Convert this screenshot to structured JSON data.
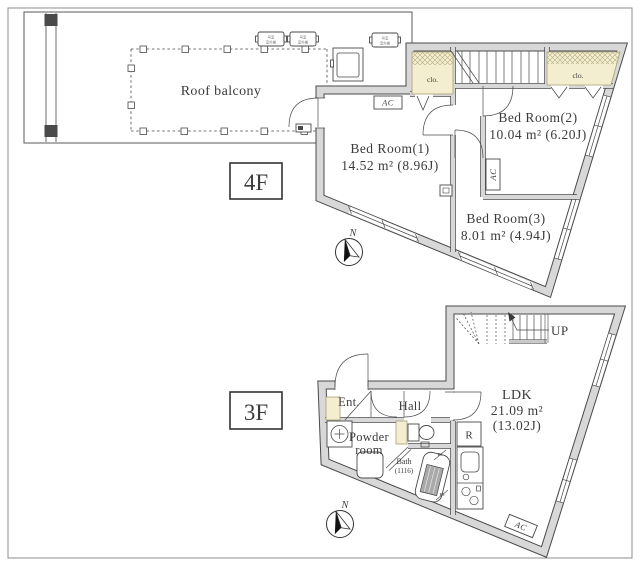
{
  "colors": {
    "line-dark": "#4a4a4a",
    "wall-fill": "#d8d8d8",
    "closet-fill": "#f2eecf",
    "closet-edge": "#a79f78",
    "ink": "#3b3b3b",
    "stair-gray": "#c9c9c9"
  },
  "f4": {
    "floor_tag": "4F",
    "balcony_label": "Roof balcony",
    "outdoor_unit_line1": "号室",
    "outdoor_unit_line2": "室外機",
    "rooms": {
      "bed1_name": "Bed Room(1)",
      "bed1_area": "14.52 m² (8.96J)",
      "bed2_name": "Bed Room(2)",
      "bed2_area": "10.04 m² (6.20J)",
      "bed3_name": "Bed Room(3)",
      "bed3_area": "8.01 m² (4.94J)"
    },
    "closet1": "clo.",
    "closet2": "clo.",
    "ac1": "AC",
    "ac2": "AC",
    "north": "N"
  },
  "f3": {
    "floor_tag": "3F",
    "rooms": {
      "ldk_name": "LDK",
      "ldk_area1": "21.09 m²",
      "ldk_area2": "(13.02J)",
      "ent": "Ent.",
      "hall": "Hall",
      "powder1": "Powder",
      "powder2": "room",
      "bath_name": "Bath",
      "bath_size": "(1116)"
    },
    "up": "UP",
    "fridge": "R",
    "ac": "AC",
    "ps1": "PS",
    "ps2": "PS",
    "north": "N"
  }
}
